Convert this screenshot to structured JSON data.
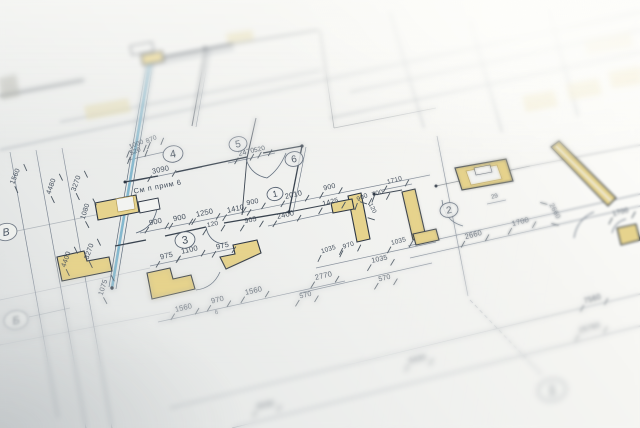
{
  "photo": {
    "drawing_note": "См п прим 6",
    "colors": {
      "paper": "#eff0ee",
      "ink": "#55616f",
      "wall_dark": "#39434f",
      "wall_yellow": "#e6d38d",
      "wall_tan_edge": "#b39c55",
      "blue_wall": "#84b8ce",
      "text_ink": "#414c5a"
    },
    "room_circles": [
      {
        "n": "4",
        "x": 173,
        "y": 154,
        "rad": 10
      },
      {
        "n": "5",
        "x": 238,
        "y": 144,
        "rad": 9
      },
      {
        "n": "6",
        "x": 294,
        "y": 159,
        "rad": 9
      },
      {
        "n": "1",
        "x": 275,
        "y": 194,
        "rad": 8
      },
      {
        "n": "3",
        "x": 185,
        "y": 240,
        "rad": 10
      },
      {
        "n": "2",
        "x": 449,
        "y": 210,
        "rad": 9
      }
    ],
    "grid_bubbles": [
      {
        "n": "В",
        "x": 6,
        "y": 232,
        "rad": 11,
        "f": 0
      },
      {
        "n": "Б",
        "x": 16,
        "y": 320,
        "rad": 12,
        "f": 1
      },
      {
        "n": "1",
        "x": 552,
        "y": 390,
        "rad": 14,
        "f": 1
      }
    ],
    "dimensions": [
      {
        "t": "1000",
        "x": 137,
        "y": 146,
        "a": -22,
        "s": 6.5
      },
      {
        "t": "520",
        "x": 136,
        "y": 153,
        "a": -22,
        "s": 6.5
      },
      {
        "t": "870",
        "x": 152,
        "y": 141,
        "a": -22,
        "s": 6.5
      },
      {
        "t": "3090",
        "x": 161,
        "y": 172,
        "a": -12,
        "s": 7.5
      },
      {
        "t": "2470",
        "x": 247,
        "y": 154,
        "a": -14,
        "s": 7
      },
      {
        "t": "520",
        "x": 260,
        "y": 151,
        "a": -14,
        "s": 6.5
      },
      {
        "t": "900",
        "x": 156,
        "y": 224,
        "a": -12,
        "s": 7.5
      },
      {
        "t": "900",
        "x": 180,
        "y": 220,
        "a": -12,
        "s": 7.5
      },
      {
        "t": "1250",
        "x": 205,
        "y": 215,
        "a": -12,
        "s": 7.5
      },
      {
        "t": "120",
        "x": 213,
        "y": 226,
        "a": -12,
        "s": 6.5
      },
      {
        "t": "1410",
        "x": 236,
        "y": 211,
        "a": -12,
        "s": 7.5
      },
      {
        "t": "905",
        "x": 251,
        "y": 222,
        "a": -12,
        "s": 7
      },
      {
        "t": "900",
        "x": 253,
        "y": 204,
        "a": -12,
        "s": 7
      },
      {
        "t": "2010",
        "x": 294,
        "y": 197,
        "a": -13,
        "s": 7.5
      },
      {
        "t": "2400",
        "x": 286,
        "y": 217,
        "a": -13,
        "s": 7.5
      },
      {
        "t": "900",
        "x": 330,
        "y": 189,
        "a": -14,
        "s": 7
      },
      {
        "t": "1425",
        "x": 331,
        "y": 204,
        "a": -14,
        "s": 7
      },
      {
        "t": "900",
        "x": 363,
        "y": 199,
        "a": -24,
        "s": 6.5
      },
      {
        "t": "700",
        "x": 378,
        "y": 195,
        "a": -16,
        "s": 6.5
      },
      {
        "t": "120",
        "x": 371,
        "y": 209,
        "a": 64,
        "s": 6
      },
      {
        "t": "1710",
        "x": 395,
        "y": 182,
        "a": -15,
        "s": 6.5
      },
      {
        "t": "975",
        "x": 167,
        "y": 258,
        "a": -13,
        "s": 7.5
      },
      {
        "t": "1100",
        "x": 190,
        "y": 252,
        "a": -13,
        "s": 7.5
      },
      {
        "t": "975",
        "x": 223,
        "y": 248,
        "a": -13,
        "s": 7.5
      },
      {
        "t": "1560",
        "x": 184,
        "y": 310,
        "a": -13,
        "s": 7.5
      },
      {
        "t": "970",
        "x": 218,
        "y": 302,
        "a": -13,
        "s": 7.5
      },
      {
        "t": "1560",
        "x": 254,
        "y": 293,
        "a": -13,
        "s": 7.5
      },
      {
        "t": "570",
        "x": 306,
        "y": 297,
        "a": -13,
        "s": 7
      },
      {
        "t": "2770",
        "x": 324,
        "y": 278,
        "a": -13,
        "s": 7.5
      },
      {
        "t": "1035",
        "x": 380,
        "y": 261,
        "a": -13,
        "s": 7
      },
      {
        "t": "570",
        "x": 385,
        "y": 280,
        "a": -13,
        "s": 7
      },
      {
        "t": "1035",
        "x": 329,
        "y": 251,
        "a": -18,
        "s": 6.5
      },
      {
        "t": "970",
        "x": 349,
        "y": 247,
        "a": -18,
        "s": 6.5
      },
      {
        "t": "1035",
        "x": 399,
        "y": 243,
        "a": -15,
        "s": 6.5
      },
      {
        "t": "6",
        "x": 217,
        "y": 314,
        "a": -13,
        "s": 6
      },
      {
        "t": "29",
        "x": 495,
        "y": 198,
        "a": -15,
        "s": 6
      },
      {
        "t": "2660",
        "x": 474,
        "y": 237,
        "a": -15,
        "s": 7.5
      },
      {
        "t": "1700",
        "x": 521,
        "y": 224,
        "a": -15,
        "s": 7.5
      },
      {
        "t": "2660",
        "x": 553,
        "y": 212,
        "a": 62,
        "s": 7
      },
      {
        "t": "1700",
        "x": 621,
        "y": 214,
        "a": -15,
        "s": 7
      },
      {
        "t": "7560",
        "x": 593,
        "y": 301,
        "a": -16,
        "s": 7.5
      },
      {
        "t": "25760",
        "x": 590,
        "y": 330,
        "a": -16,
        "s": 7.5,
        "f": 1
      },
      {
        "t": "6030",
        "x": 266,
        "y": 407,
        "a": -13,
        "s": 7.5,
        "f": 1
      },
      {
        "t": "6430",
        "x": 418,
        "y": 361,
        "a": -14,
        "s": 7.5,
        "f": 1
      },
      {
        "t": "1560",
        "x": 17,
        "y": 177,
        "a": -68,
        "s": 7
      },
      {
        "t": "4480",
        "x": 53,
        "y": 187,
        "a": -70,
        "s": 7
      },
      {
        "t": "3270",
        "x": 78,
        "y": 184,
        "a": -70,
        "s": 7
      },
      {
        "t": "1080",
        "x": 87,
        "y": 212,
        "a": -72,
        "s": 7
      },
      {
        "t": "4400",
        "x": 68,
        "y": 260,
        "a": -70,
        "s": 7
      },
      {
        "t": "3270",
        "x": 91,
        "y": 252,
        "a": -70,
        "s": 7
      },
      {
        "t": "1075",
        "x": 105,
        "y": 288,
        "a": -72,
        "s": 7
      }
    ]
  }
}
